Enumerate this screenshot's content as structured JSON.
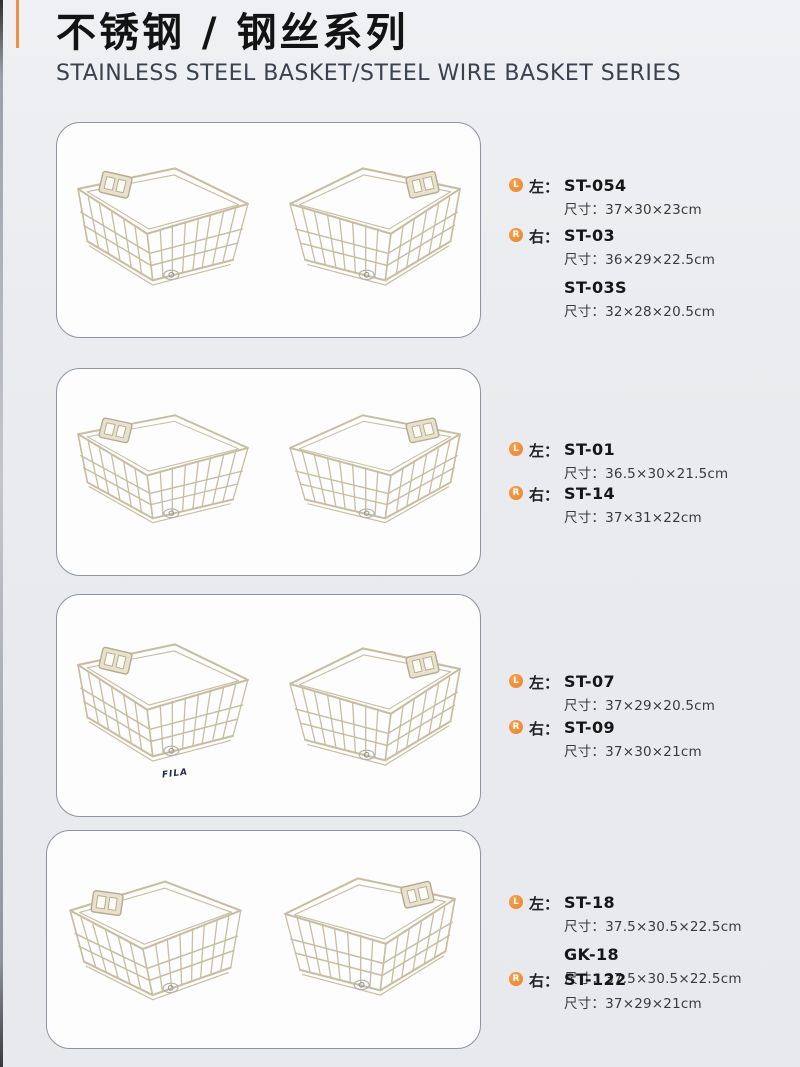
{
  "page": {
    "title_cn": "不锈钢 / 钢丝系列",
    "title_en": "STAINLESS STEEL BASKET/STEEL WIRE BASKET SERIES"
  },
  "colors": {
    "accent_orange": "#ef8a33",
    "wire": "#c9bfa2",
    "page_bg": "#e9ebee",
    "panel_border": "#8d93a2",
    "title": "#131313",
    "subtitle": "#39424e"
  },
  "icons": {
    "left_bullet": "L",
    "right_bullet": "R"
  },
  "sections": [
    {
      "items": [
        {
          "bullet": "L",
          "side": "左：",
          "models": [
            {
              "code": "ST-054",
              "size": "尺寸：37×30×23cm"
            }
          ]
        },
        {
          "bullet": "R",
          "side": "右：",
          "models": [
            {
              "code": "ST-03",
              "size": "尺寸：36×29×22.5cm"
            },
            {
              "code": "ST-03S",
              "size": "尺寸：32×28×20.5cm"
            }
          ]
        }
      ]
    },
    {
      "items": [
        {
          "bullet": "L",
          "side": "左：",
          "models": [
            {
              "code": "ST-01",
              "size": "尺寸：36.5×30×21.5cm"
            }
          ]
        },
        {
          "bullet": "R",
          "side": "右：",
          "models": [
            {
              "code": "ST-14",
              "size": "尺寸：37×31×22cm"
            }
          ]
        }
      ]
    },
    {
      "watermark": "FILA",
      "items": [
        {
          "bullet": "L",
          "side": "左：",
          "models": [
            {
              "code": "ST-07",
              "size": "尺寸：37×29×20.5cm"
            }
          ]
        },
        {
          "bullet": "R",
          "side": "右：",
          "models": [
            {
              "code": "ST-09",
              "size": "尺寸：37×30×21cm"
            }
          ]
        }
      ]
    },
    {
      "items": [
        {
          "bullet": "L",
          "side": "左：",
          "models": [
            {
              "code": "ST-18",
              "size": "尺寸：37.5×30.5×22.5cm"
            },
            {
              "code": "GK-18",
              "size": "尺寸：37.5×30.5×22.5cm"
            }
          ]
        },
        {
          "bullet": "R",
          "side": "右：",
          "models": [
            {
              "code": "ST-122",
              "size": "尺寸：37×29×21cm"
            }
          ]
        }
      ]
    }
  ]
}
